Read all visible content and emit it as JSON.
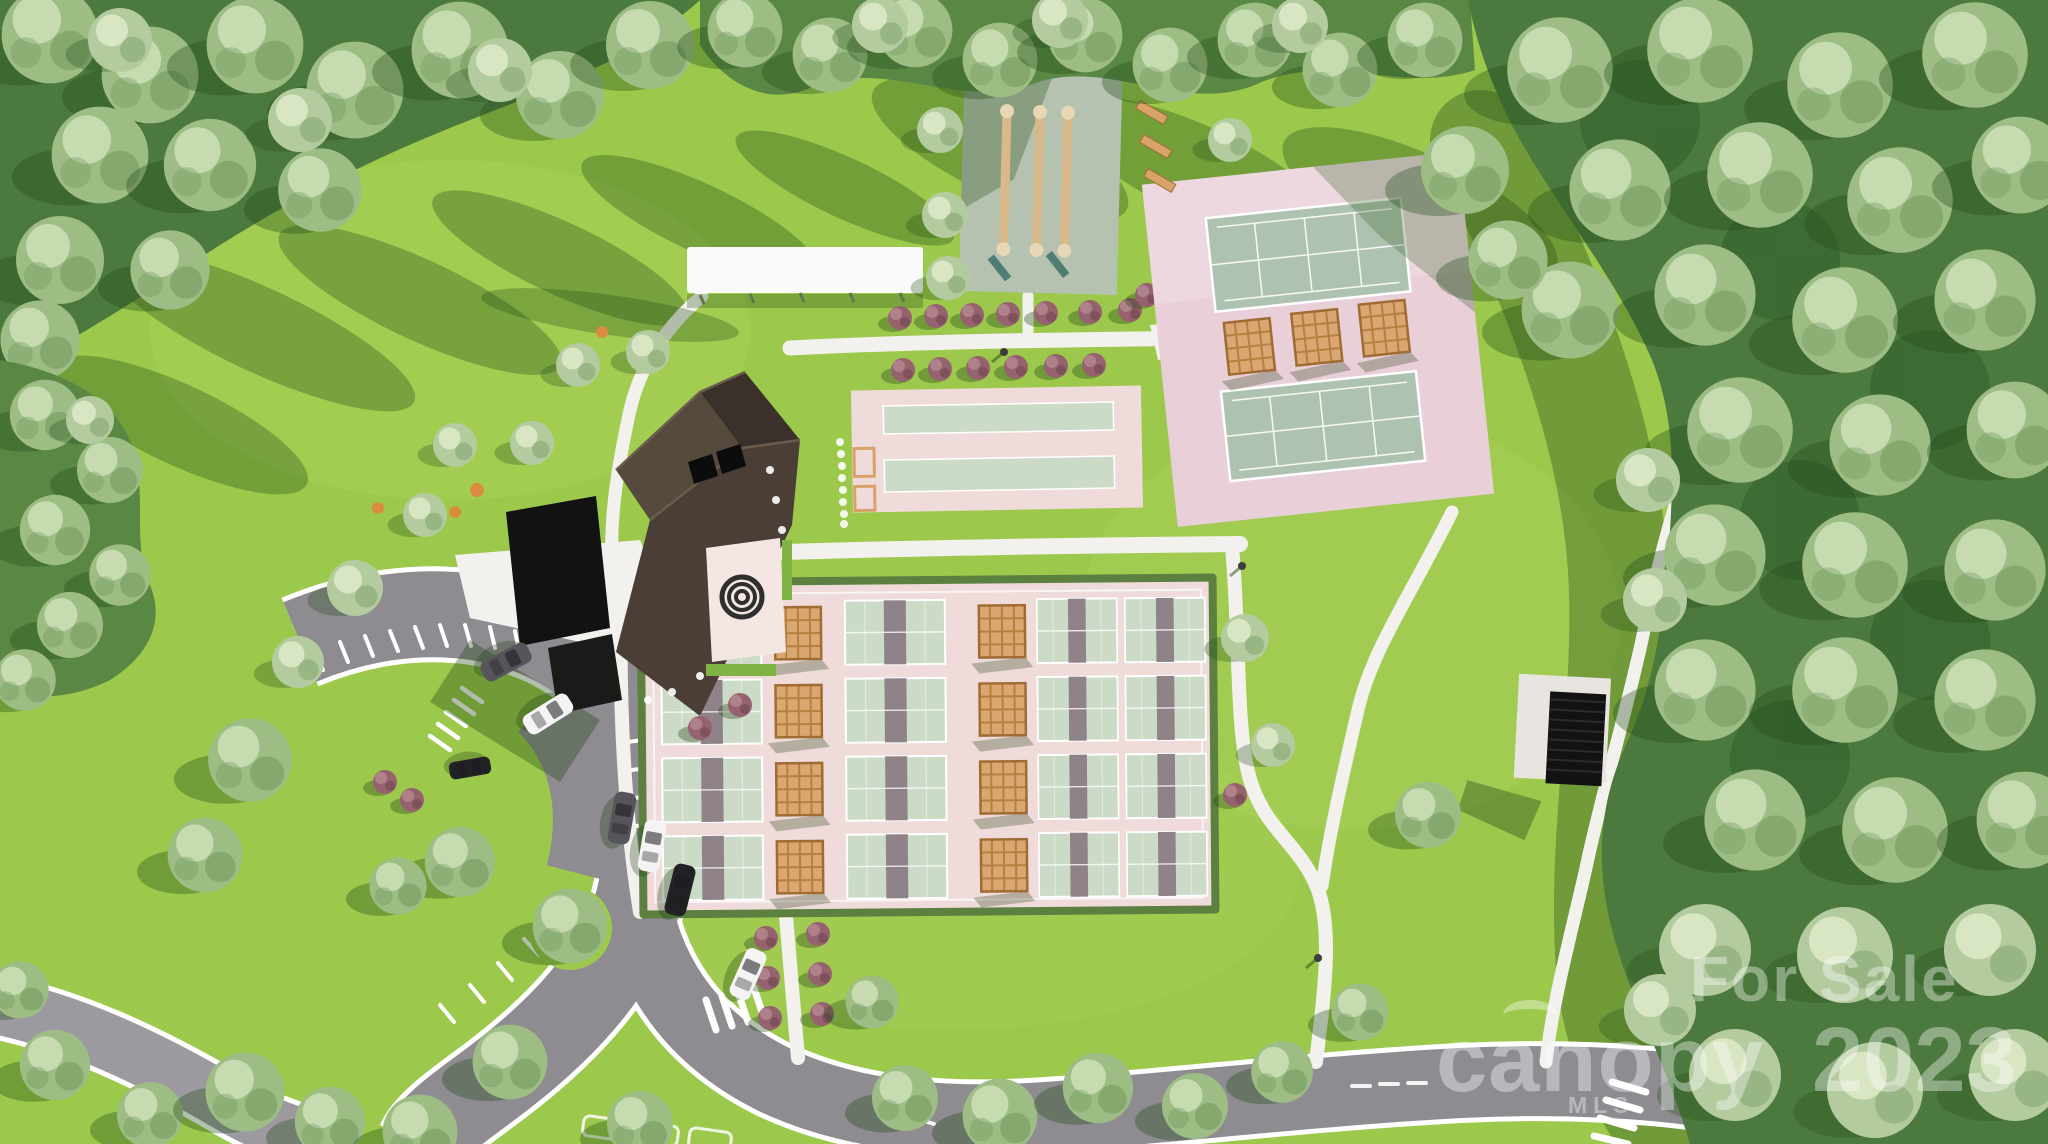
{
  "watermark": {
    "for_sale": "For Sale",
    "brand": "canopy",
    "year": "2023",
    "mls": "MLS"
  },
  "scene": {
    "type": "aerial-3d-site-plan-rendering",
    "features": [
      "clubhouse-building",
      "rose-patio-courtyard",
      "spiral-hedge-garden",
      "shuffleboard-courts",
      "bocce-courts",
      "tennis-courts",
      "pickleball-courts",
      "pergola-shade-structures",
      "white-cabana-structure",
      "pavilion",
      "parking-lot",
      "cars",
      "walking-paths",
      "access-road",
      "crosswalks",
      "tree-groves",
      "ornamental-shrubs"
    ],
    "counts": {
      "shuffleboard_lanes": 3,
      "bocce_lanes": 2,
      "tennis_courts": 2,
      "pickleball_court_cells": 16,
      "cars": 7
    }
  },
  "palette": {
    "grass": "#9cc94b",
    "grassLight": "#aed45f",
    "path": "#f3f1ee",
    "road": "#8e8c91",
    "roadLight": "#9c9aa0",
    "padPink": "#efdbda",
    "tennisPink": "#e9cfd8",
    "courtMint": "#ccdbc7",
    "tennisMint": "#adc2b1",
    "netMauve": "#8f8389",
    "shufflePad": "#b5c2af",
    "lane": "#d9b98a",
    "wood": "#d8a368",
    "shrub": "#96626e",
    "shrubDark": "#744a56",
    "treeBase": "#4c7a3e",
    "treeLight": "#cfe0b8",
    "treeMid": "#9dbd85",
    "treeDark": "#6d9459",
    "treeGray": "#b4cba0",
    "roofLight": "#564a3c",
    "roofMid": "#4a3e36",
    "roofDark": "#3b312b",
    "black": "#121212",
    "white": "#fbfafa",
    "teal": "#4f7d74",
    "orangeBush": "#d98c3f",
    "carWhite": "#f4f4f4",
    "carBlack": "#222226",
    "carGray": "#55555b",
    "watermark": "rgba(255,255,255,0.38)"
  }
}
